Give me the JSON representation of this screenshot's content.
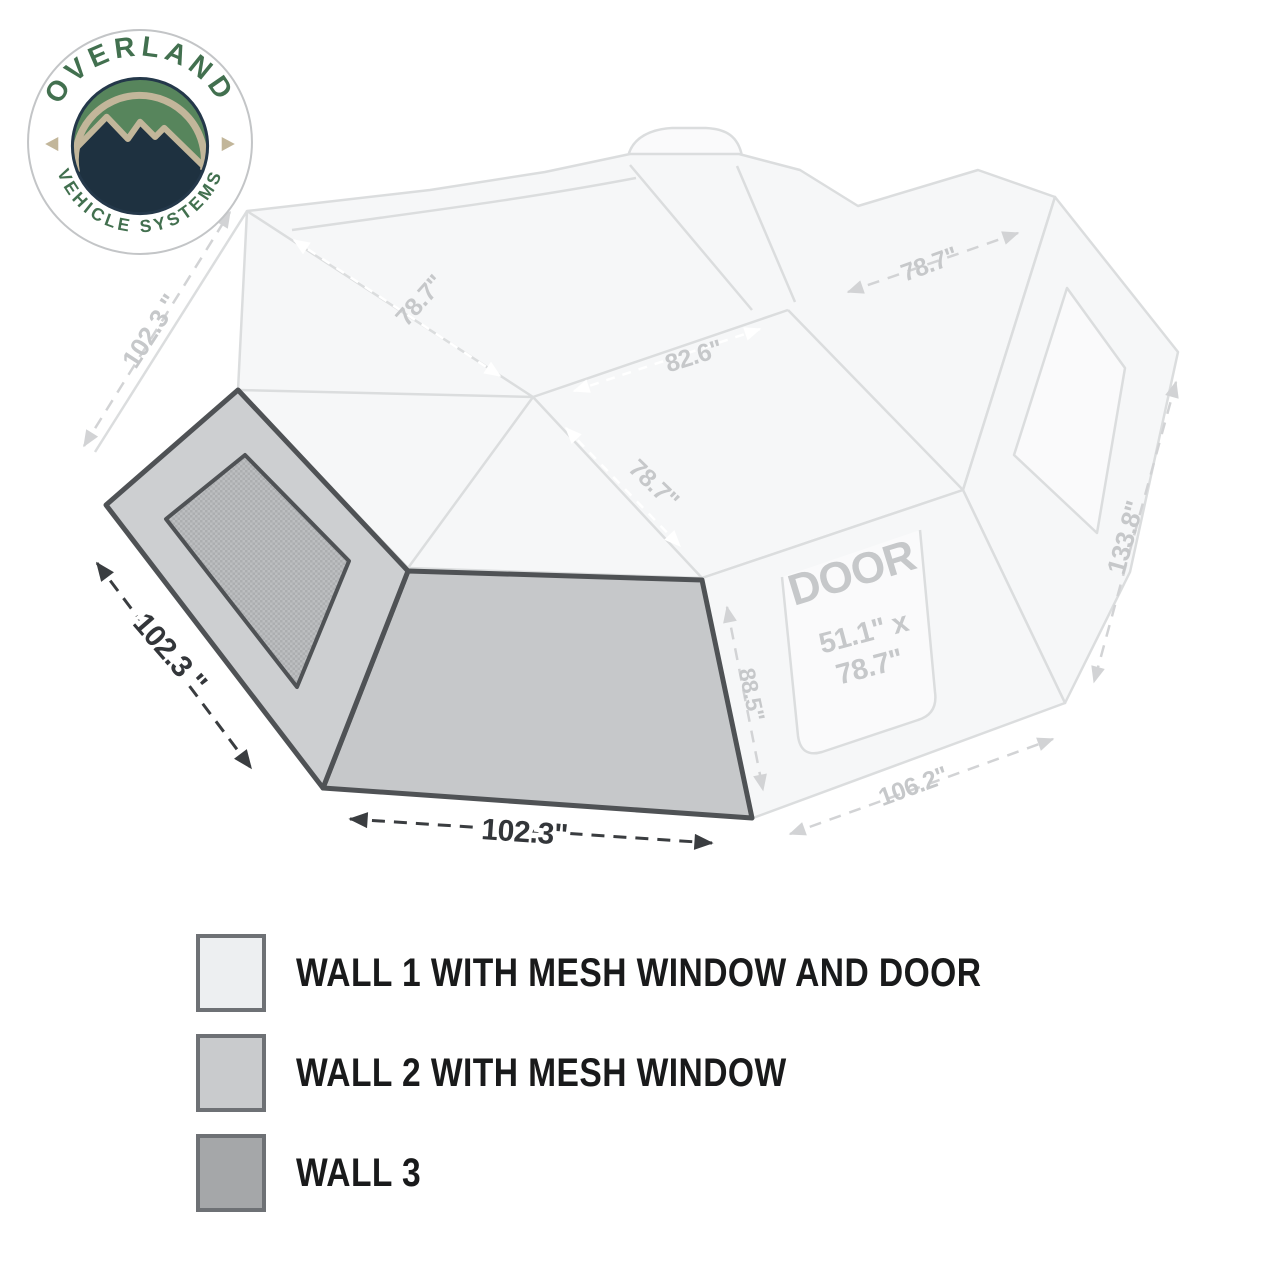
{
  "brand": {
    "arc_top": "OVERLAND",
    "arc_bottom": "VEHICLE SYSTEMS",
    "colors": {
      "green_text": "#42704f",
      "field_green": "#57855c",
      "navy": "#1e3140",
      "tan": "#c2b69a",
      "ring_border": "#c3c5c7"
    }
  },
  "diagram": {
    "dims": {
      "wall2_width": "102.3 \"",
      "wall3_width": "102.3\""
    },
    "faint_dims": {
      "ridge_left": "78.7\"",
      "ridge_center": "82.6\"",
      "ridge_front": "78.7\"",
      "top_right": "78.7\"",
      "overall_side": "133.8\"",
      "door_wall_height": "88.5\"",
      "door_wall_width": "106.2\"",
      "left_edge": "102.3 \"",
      "door_label": "DOOR",
      "door_size_l1": "51.1\" x",
      "door_size_l2": "78.7\""
    },
    "colors": {
      "wall2_fill": "#cdcfd1",
      "wall3_fill": "#c6c8ca",
      "wall_outline": "#4f5255",
      "dim_dark": "#33363a",
      "faint_line": "#dcdee0"
    }
  },
  "legend": {
    "items": [
      {
        "label": "WALL 1 WITH MESH WINDOW AND DOOR",
        "swatch": "#edeff1"
      },
      {
        "label": "WALL 2 WITH MESH WINDOW",
        "swatch": "#c9cbcd"
      },
      {
        "label": "WALL 3",
        "swatch": "#a5a7a9"
      }
    ],
    "swatch_border": "#6e7175"
  }
}
